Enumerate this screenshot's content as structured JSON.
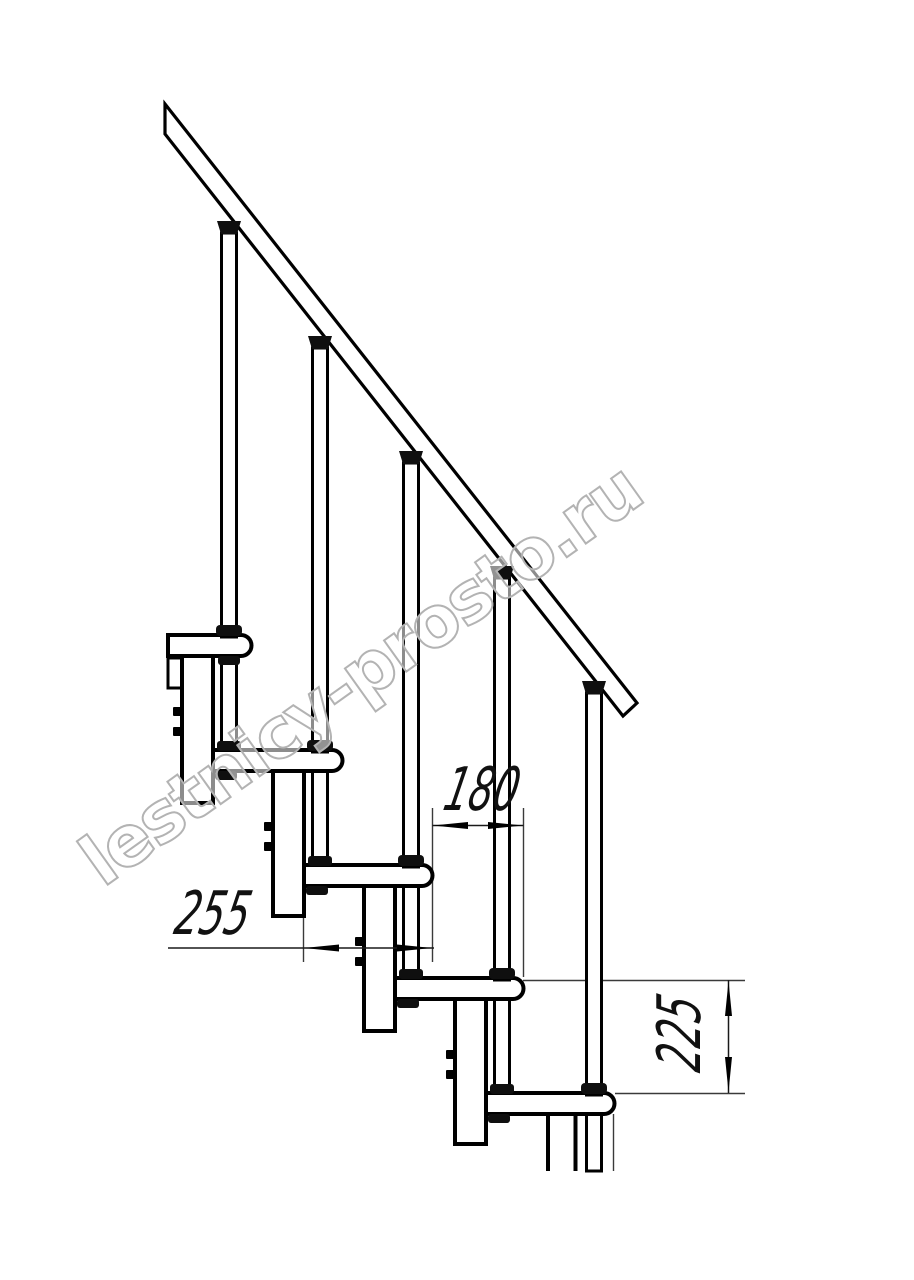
{
  "watermark": {
    "text": "lestnicy-prosto.ru",
    "stroke_color": "#b3b3b3",
    "fill_color": "rgba(255,255,255,0.55)"
  },
  "dimensions": {
    "step_run": "180",
    "tread_depth": "255",
    "step_rise": "225"
  },
  "colors": {
    "ink": "#000000",
    "thin_line": "#3a3a3a",
    "background": "#ffffff"
  }
}
